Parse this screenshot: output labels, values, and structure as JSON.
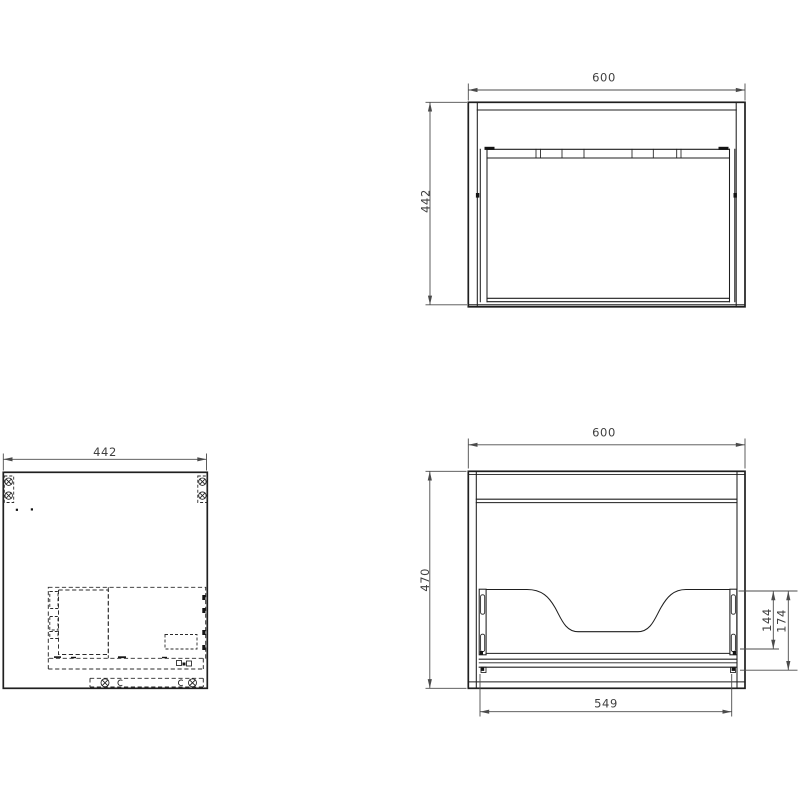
{
  "drawing": {
    "background": "#ffffff",
    "object_line_color": "#1f1f1f",
    "hidden_line_color": "#2a2a2a",
    "dimension_line_color": "#4b4b4b",
    "dimension_text_color": "#3f3f3f",
    "views": {
      "top": {
        "name": "top-view-carcass",
        "dim_width": "600",
        "dim_depth": "442"
      },
      "side": {
        "name": "side-view-panel",
        "dim_depth": "442"
      },
      "front": {
        "name": "front-view-carcass",
        "dim_width": "600",
        "dim_height": "470",
        "dim_slide_height": "144",
        "dim_rail_offset": "174",
        "dim_inner_width": "549"
      }
    }
  }
}
